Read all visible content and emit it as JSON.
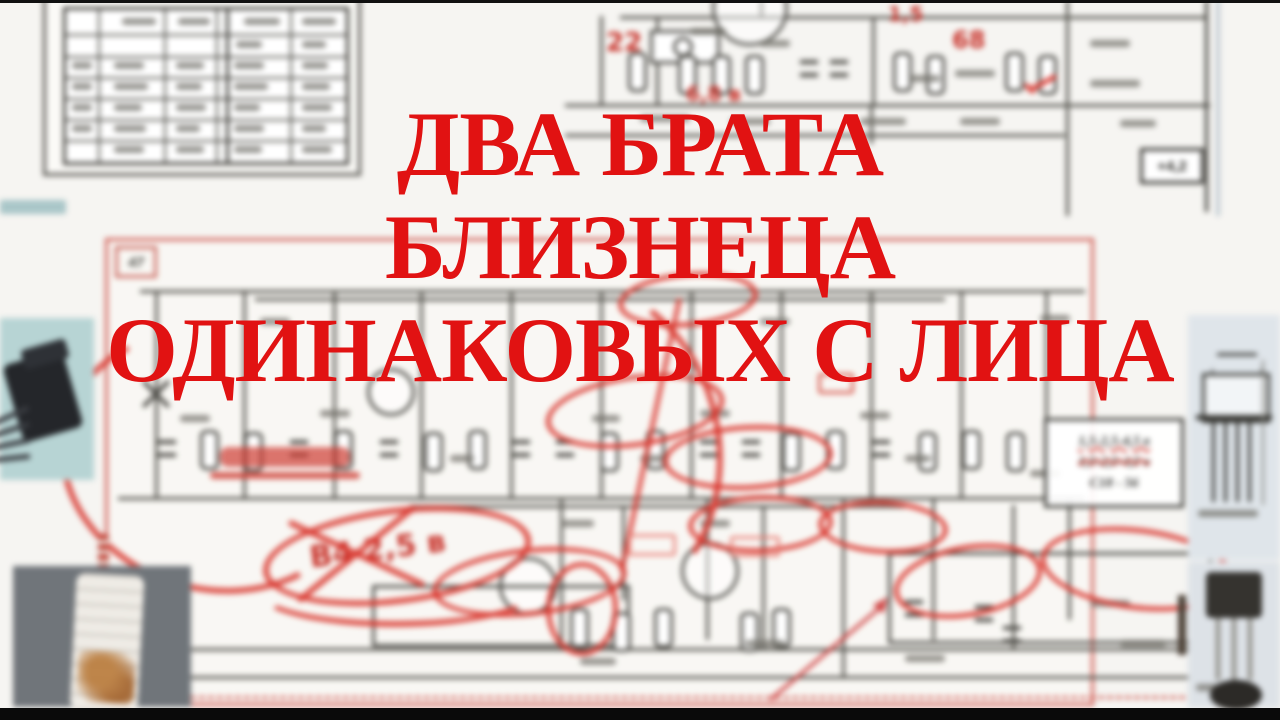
{
  "title": {
    "line1": "ДВА БРАТА",
    "line2": "БЛИЗНЕЦА",
    "line3": "ОДИНАКОВЫХ С ЛИЦА"
  },
  "schematic": {
    "page_label": "47",
    "annotations": {
      "tr_22": "22",
      "tr_68v": "6,8 в",
      "tr_15": "1,5",
      "tr_68": "68",
      "voltage_box": "+4,2",
      "crossed_note": "В4 2,5 в"
    },
    "note_box": {
      "line1": "1,5-2,5-4,5 в",
      "line2": "1,5-2,5-4,5 в",
      "line3": "С18 - 56"
    }
  },
  "colors": {
    "title_red": "#e11212",
    "marker_red": "#d8342c",
    "schematic_ink": "#4c4b46",
    "teal_photo_bg": "#b7d4d4",
    "gray_photo_bg": "#70757a",
    "panel_bg": "#dfe5ea",
    "paper": "#f6f5f2"
  }
}
